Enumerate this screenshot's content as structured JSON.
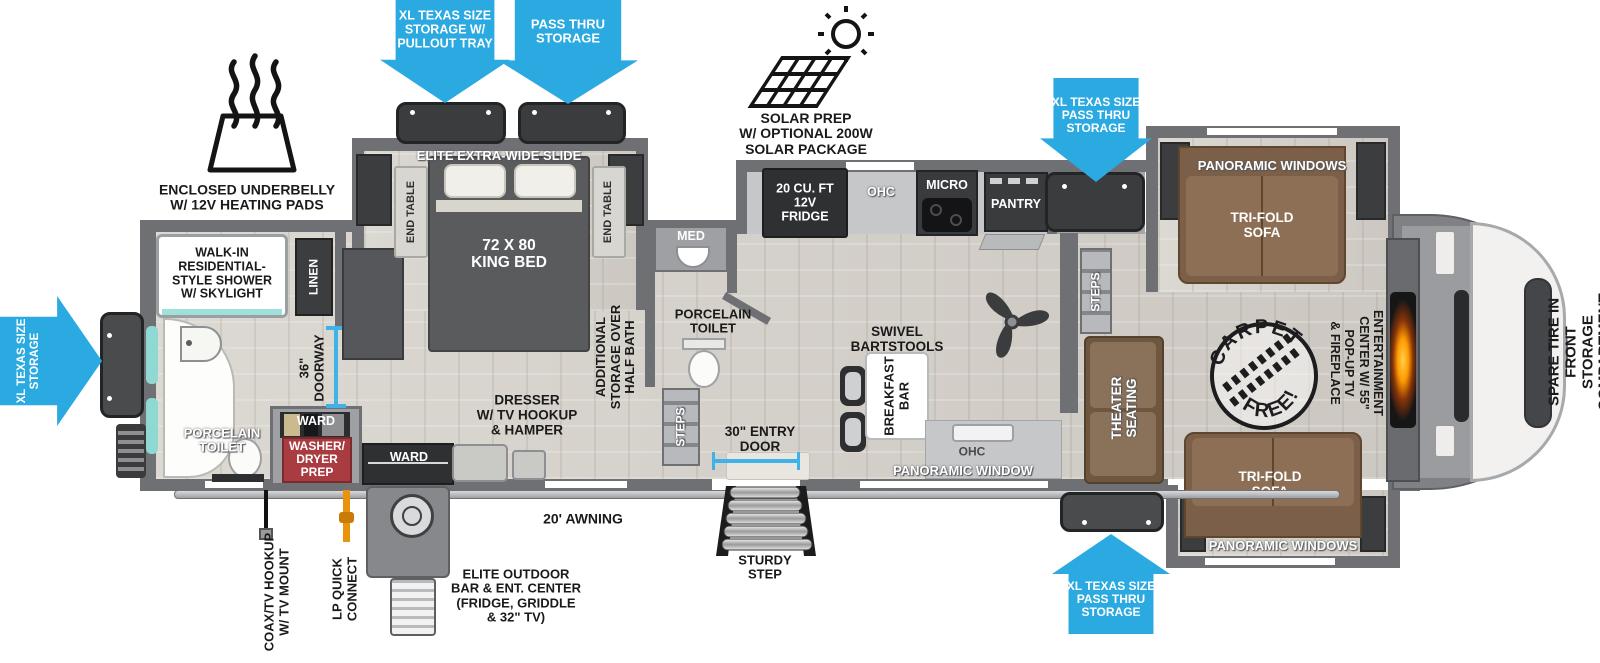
{
  "floorplan": {
    "arrows": {
      "rear_storage": "XL TEXAS SIZE\nSTORAGE",
      "storage_pullout": "XL TEXAS SIZE\nSTORAGE W/\nPULLOUT TRAY",
      "pass_thru": "PASS THRU\nSTORAGE",
      "front_top_passthru": "XL TEXAS SIZE\nPASS THRU\nSTORAGE",
      "front_bottom_passthru": "XL TEXAS SIZE\nPASS THRU\nSTORAGE"
    },
    "callouts": {
      "underbelly": "ENCLOSED UNDERBELLY\nW/ 12V HEATING PADS",
      "solar": "SOLAR PREP\nW/ OPTIONAL 200W\nSOLAR PACKAGE",
      "awning": "20' AWNING",
      "entry_door": "30\" ENTRY\nDOOR",
      "sturdy_step": "STURDY\nSTEP",
      "coax": "COAX/TV HOOKUP\nW/ TV MOUNT",
      "lp_connect": "LP QUICK\nCONNECT",
      "outdoor_bar": "ELITE OUTDOOR\nBAR & ENT. CENTER\n(FRIDGE, GRIDDLE\n& 32\" TV)",
      "spare_tire": "SPARE TIRE IN FRONT\nSTORAGE COMPARTMENT",
      "carpet_arc_top": "CARPET",
      "carpet_arc_bottom": "FREE!"
    },
    "bedroom": {
      "slide": "ELITE EXTRA-WIDE SLIDE",
      "end_table_left": "END TABLE",
      "end_table_right": "END TABLE",
      "bed": "72 X 80\nKING BED",
      "dresser": "DRESSER\nW/ TV HOOKUP\n& HAMPER",
      "ward": "WARD",
      "doorway": "36\"\nDOORWAY"
    },
    "rear_bath": {
      "shower": "WALK-IN\nRESIDENTIAL-\nSTYLE SHOWER\nW/ SKYLIGHT",
      "linen": "LINEN",
      "toilet": "PORCELAIN\nTOILET",
      "ward": "WARD",
      "washer_dryer": "WASHER/\nDRYER\nPREP"
    },
    "half_bath": {
      "med": "MED",
      "overhead_storage": "ADDITIONAL\nSTORAGE OVER\nHALF BATH",
      "toilet": "PORCELAIN\nTOILET",
      "steps": "STEPS"
    },
    "kitchen": {
      "fridge": "20 CU. FT\n12V\nFRIDGE",
      "ohc": "OHC",
      "micro": "MICRO",
      "pantry": "PANTRY",
      "barstools": "SWIVEL\nBARTSTOOLS",
      "breakfast_bar": "BREAKFAST\nBAR",
      "ohc_lower": "OHC",
      "window": "PANORAMIC WINDOW"
    },
    "living": {
      "steps": "STEPS",
      "theater": "THEATER\nSEATING",
      "entertainment": "ENTERTAINMENT\nCENTER W/ 55\"\nPOP-UP TV\n& FIREPLACE",
      "sofa_top": "TRI-FOLD\nSOFA",
      "windows_top": "PANORAMIC WINDOWS",
      "sofa_bottom": "TRI-FOLD\nSOFA",
      "windows_bottom": "PANORAMIC WINDOWS"
    },
    "colors": {
      "arrow_blue": "#2ba9e1",
      "wall_gray": "#6f7073",
      "sofa_brown": "#8a6c54",
      "accent_red": "#a93c40",
      "teal": "#8fd8d4",
      "fire_orange": "#ff9a00"
    }
  }
}
